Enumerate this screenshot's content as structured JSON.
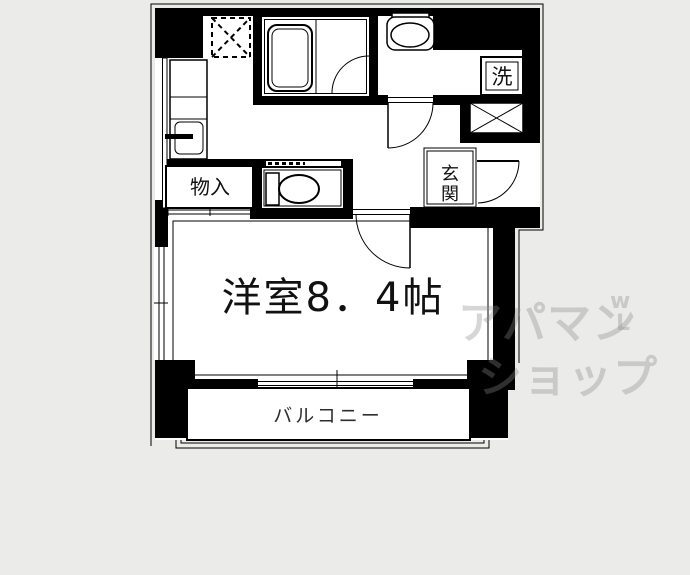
{
  "floorplan": {
    "type": "apartment-floor-plan",
    "labels": {
      "main_room": "洋室8．4帖",
      "balcony": "バルコニー",
      "storage": "物入",
      "entrance_char1": "玄",
      "entrance_char2": "関",
      "laundry": "洗"
    },
    "watermark": {
      "line1": "アパマン",
      "line2": "ショップ",
      "mark_top": "w",
      "mark_bottom": "L"
    },
    "colors": {
      "background": "#ebebe9",
      "walls": "#000000",
      "interior": "#ffffff",
      "watermark_gray": "#8a8a8a",
      "balcony_text": "#2e2e2e"
    }
  }
}
